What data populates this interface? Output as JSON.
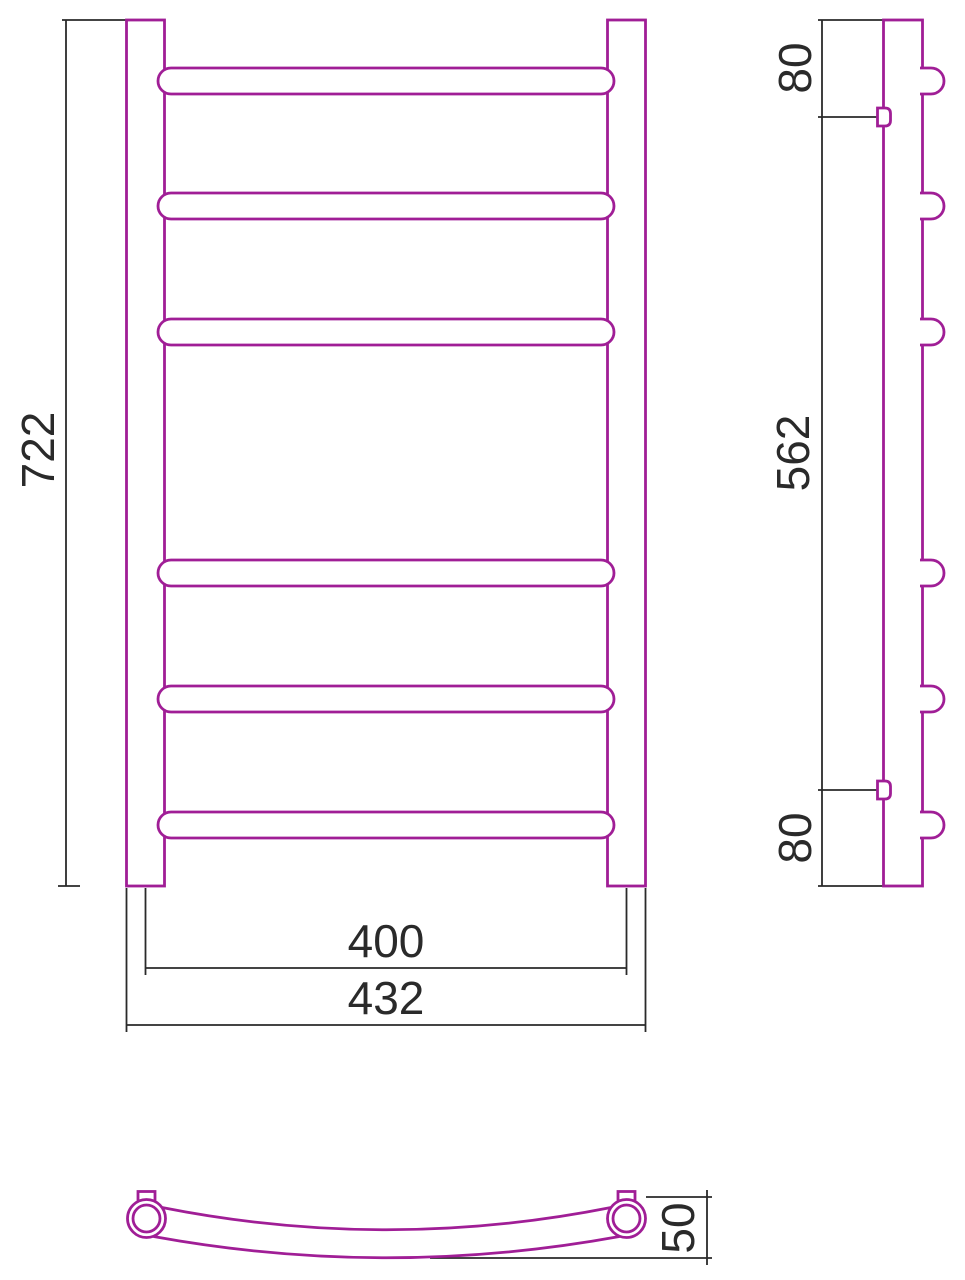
{
  "drawing": {
    "dimensions": {
      "front_height": "722",
      "side_top_offset": "80",
      "side_bracket_span": "562",
      "side_bottom_offset": "80",
      "bar_center_width": "400",
      "overall_width": "432",
      "plan_depth": "50"
    }
  },
  "colors": {
    "drawing_outline": "#a01e96",
    "dimension_ink": "#2a2a2a",
    "background": "#ffffff"
  }
}
